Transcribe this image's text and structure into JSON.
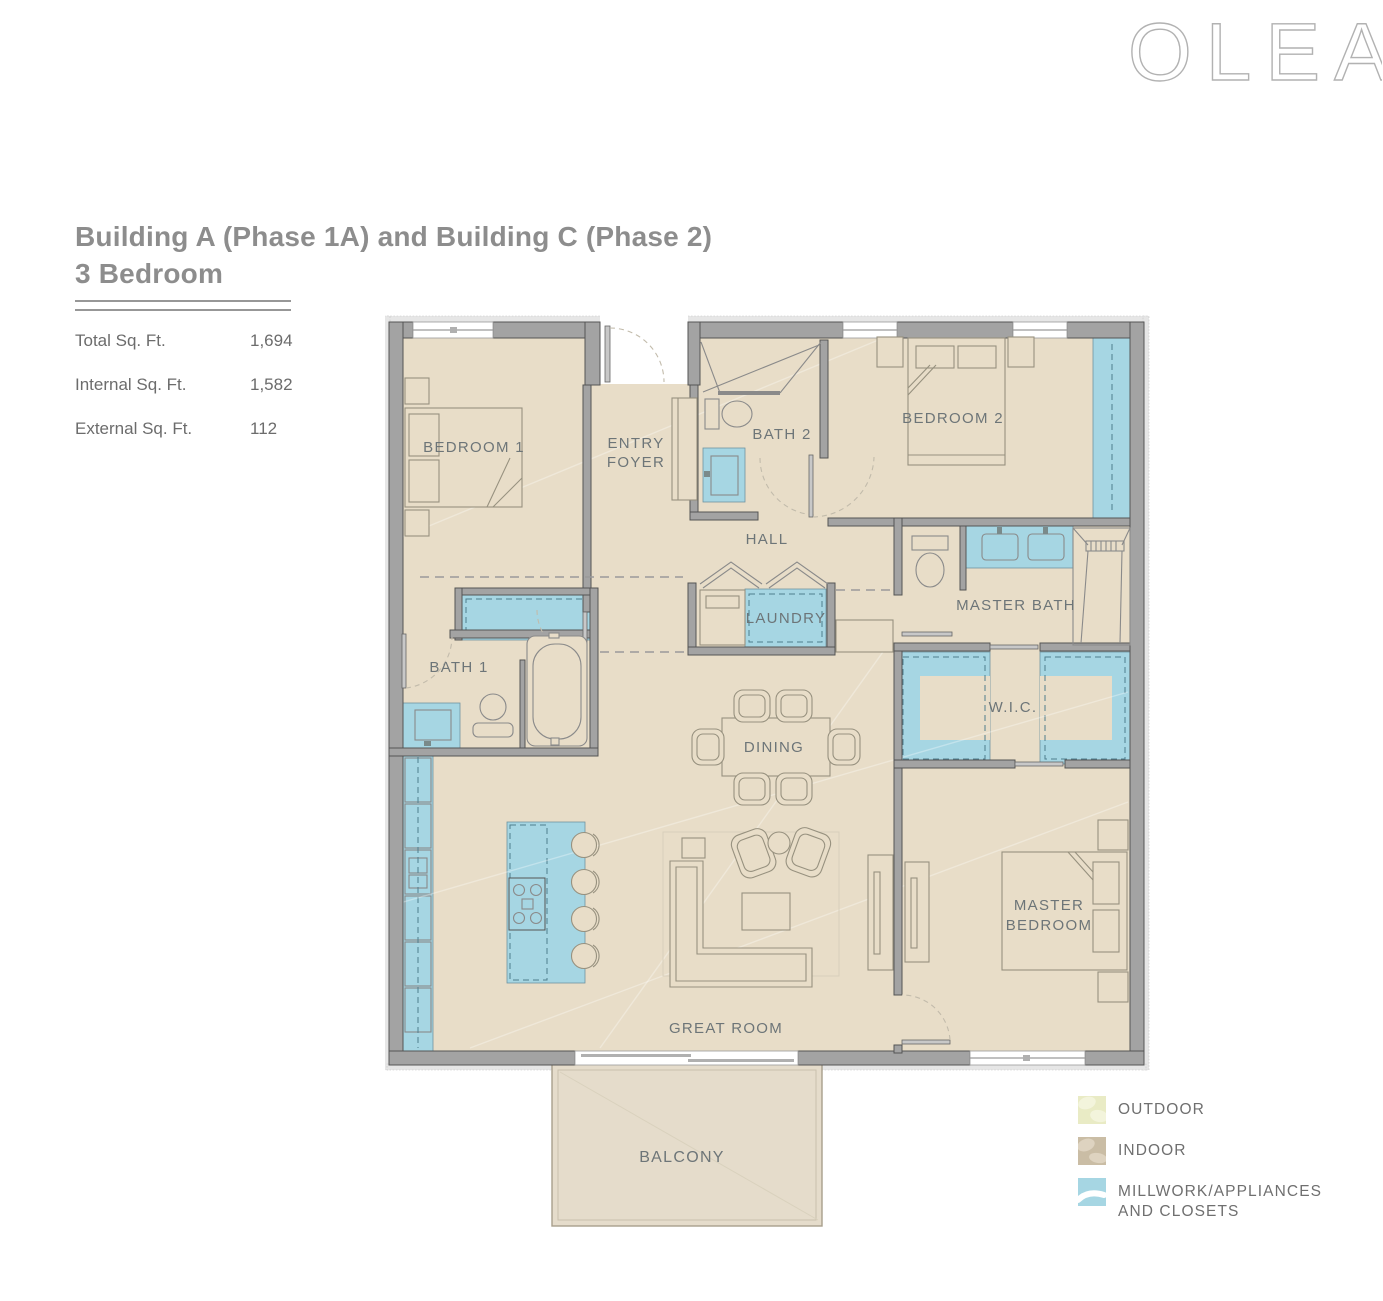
{
  "brand": {
    "logo": "OLEA"
  },
  "header": {
    "title_line1": "Building A (Phase 1A) and Building C (Phase 2)",
    "title_line2": "3 Bedroom"
  },
  "stats": {
    "rows": [
      {
        "label": "Total Sq. Ft.",
        "value": "1,694"
      },
      {
        "label": "Internal Sq. Ft.",
        "value": "1,582"
      },
      {
        "label": "External Sq. Ft.",
        "value": "112"
      }
    ]
  },
  "floorplan": {
    "labels": {
      "bedroom1": "BEDROOM 1",
      "entry_line1": "ENTRY",
      "entry_line2": "FOYER",
      "bath2": "BATH 2",
      "bedroom2": "BEDROOM 2",
      "hall": "HALL",
      "laundry": "LAUNDRY",
      "master_bath": "MASTER BATH",
      "bath1": "BATH 1",
      "wic": "W.I.C.",
      "dining": "DINING",
      "master_line1": "MASTER",
      "master_line2": "BEDROOM",
      "great_room": "GREAT ROOM",
      "balcony": "BALCONY"
    }
  },
  "legend": {
    "items": [
      {
        "label": "OUTDOOR",
        "color": "#e9ebc5"
      },
      {
        "label": "INDOOR",
        "color": "#cabda5"
      },
      {
        "label_line1": "MILLWORK/APPLIANCES",
        "label_line2": "AND CLOSETS",
        "color": "#a6d6e3"
      }
    ]
  },
  "colors": {
    "indoor_floor": "#e8ddc8",
    "balcony_floor": "#e5dccb",
    "millwork_blue": "#a6d6e3",
    "wall_gray": "#a3a3a3",
    "label_gray": "#6d7578",
    "title_gray": "#8d8d8d"
  }
}
